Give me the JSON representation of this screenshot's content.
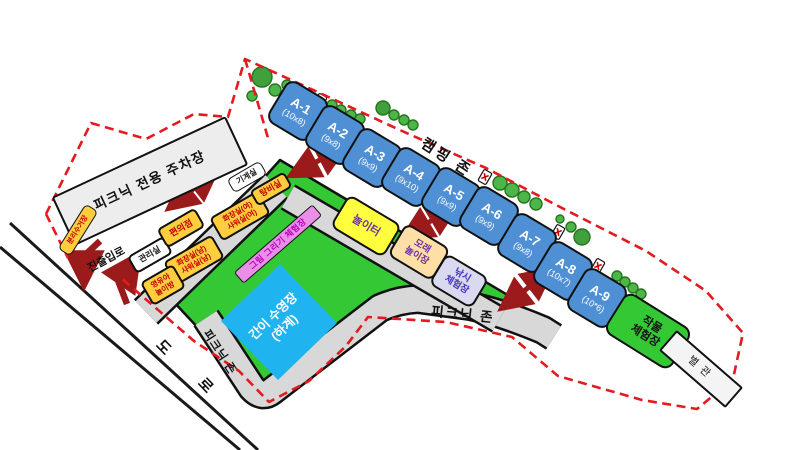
{
  "zones": {
    "camping_zone": "캠핑 존",
    "picnic_zone_band_right": "피크닉 존",
    "picnic_zone_band_left": "피크닉 존",
    "parking": "피크닉 전용 주차장",
    "entrance": "진출입로",
    "road_char_1": "도",
    "road_char_2": "로"
  },
  "sites": [
    {
      "name": "A-1",
      "dims": "(10x8)"
    },
    {
      "name": "A-2",
      "dims": "(9x8)"
    },
    {
      "name": "A-3",
      "dims": "(9x9)"
    },
    {
      "name": "A-4",
      "dims": "(9x10)"
    },
    {
      "name": "A-5",
      "dims": "(9x9)"
    },
    {
      "name": "A-6",
      "dims": "(9x9)"
    },
    {
      "name": "A-7",
      "dims": "(9x8)"
    },
    {
      "name": "A-8",
      "dims": "(10x7)"
    },
    {
      "name": "A-9",
      "dims": "(10*6)"
    }
  ],
  "facilities": {
    "office": {
      "line1": "관리실"
    },
    "store": {
      "line1": "편의점"
    },
    "toilet_m": {
      "line1": "화장실(남)",
      "line2": "샤워실(남)"
    },
    "toddler": {
      "line1": "영유아",
      "line2": "놀이방"
    },
    "toilet_f": {
      "line1": "화장실(여)",
      "line2": "샤워실(여)"
    },
    "pantry": {
      "line1": "탕비실"
    },
    "machine": {
      "line1": "기계실"
    },
    "recycle": {
      "line1": "분리수거장"
    }
  },
  "activities": {
    "playground": {
      "line1": "놀이터"
    },
    "sand": {
      "line1": "모래",
      "line2": "놀이장"
    },
    "fishing": {
      "line1": "낚시",
      "line2": "체험장"
    },
    "drawing": {
      "line1": "그림 그리기 체험장"
    },
    "crops": {
      "line1": "작물",
      "line2": "체험장"
    },
    "pool": {
      "line1": "간이 수영장",
      "line2": "(하계)"
    },
    "annex": {
      "line1": "별관"
    }
  },
  "colors": {
    "site_blue": "#4F90D5",
    "field_green": "#35C835",
    "facility_orange": "#FFCE3F",
    "facility_text_red": "#C00000",
    "playground_yellow": "#FFFF3D",
    "sand_tan": "#FFDFA6",
    "fishing_lavender": "#D9D9EF",
    "drawing_pink": "#EA8FE8",
    "pool_blue": "#1FB4F0",
    "path_gray": "#D8D8D8",
    "boundary_red_dashed": "#E31A1F",
    "arrow_dark_red": "#9B1B1B"
  }
}
